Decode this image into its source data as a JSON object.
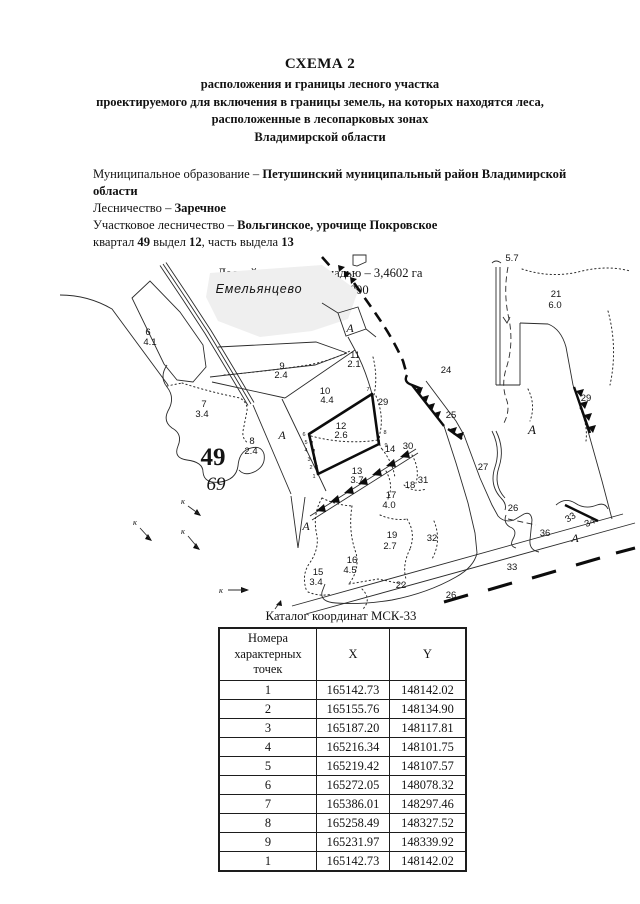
{
  "header": {
    "title": "СХЕМА 2",
    "subtitle": [
      "расположения и границы лесного участка",
      "проектируемого для включения в границы земель, на которых находятся леса,",
      "расположенные в лесопарковых зонах",
      "Владимирской области"
    ]
  },
  "info": {
    "municipal_label": "Муниципальное образование – ",
    "municipal_value": "Петушинский муниципальный район Владимирской области",
    "forestry_label": "Лесничество – ",
    "forestry_value": "Заречное",
    "district_label": "Участковое лесничество – ",
    "district_value": "Вольгинское, урочище Покровское",
    "quarter": {
      "p1": "квартал ",
      "n1": "49",
      "p2": " выдел ",
      "n2": "12",
      "p3": ", часть выдела ",
      "n3": "13"
    }
  },
  "map": {
    "area_line": "Лесной участок площадью – 3,4602 га",
    "scale_line": "Масштаб 1:10 000",
    "labels": [
      {
        "t": "Емельянцево",
        "x": 199,
        "y": 40,
        "c": "vil"
      },
      {
        "t": "5.7",
        "x": 452,
        "y": 8,
        "c": "n"
      },
      {
        "t": "21",
        "x": 496,
        "y": 44,
        "c": "n"
      },
      {
        "t": "6.0",
        "x": 495,
        "y": 55,
        "c": "n"
      },
      {
        "t": "6",
        "x": 88,
        "y": 82,
        "c": "n"
      },
      {
        "t": "4.1",
        "x": 90,
        "y": 92,
        "c": "n"
      },
      {
        "t": "7",
        "x": 144,
        "y": 154,
        "c": "n"
      },
      {
        "t": "3.4",
        "x": 142,
        "y": 164,
        "c": "n"
      },
      {
        "t": "9",
        "x": 222,
        "y": 116,
        "c": "n"
      },
      {
        "t": "2.4",
        "x": 221,
        "y": 125,
        "c": "n"
      },
      {
        "t": "10",
        "x": 265,
        "y": 141,
        "c": "n"
      },
      {
        "t": "4.4",
        "x": 267,
        "y": 150,
        "c": "n"
      },
      {
        "t": "11",
        "x": 295,
        "y": 105,
        "c": "n"
      },
      {
        "t": "2.1",
        "x": 294,
        "y": 114,
        "c": "n"
      },
      {
        "t": "29",
        "x": 323,
        "y": 152,
        "c": "n"
      },
      {
        "t": "24",
        "x": 386,
        "y": 120,
        "c": "n"
      },
      {
        "t": "25",
        "x": 391,
        "y": 165,
        "c": "n"
      },
      {
        "t": "29",
        "x": 526,
        "y": 148,
        "c": "n"
      },
      {
        "t": "12",
        "x": 281,
        "y": 176,
        "c": "n"
      },
      {
        "t": "2.6",
        "x": 281,
        "y": 185,
        "c": "n"
      },
      {
        "t": "8",
        "x": 192,
        "y": 191,
        "c": "n"
      },
      {
        "t": "2.4",
        "x": 191,
        "y": 201,
        "c": "n"
      },
      {
        "t": "13",
        "x": 297,
        "y": 221,
        "c": "n"
      },
      {
        "t": "3.7",
        "x": 297,
        "y": 230,
        "c": "n"
      },
      {
        "t": "14",
        "x": 330,
        "y": 199,
        "c": "n"
      },
      {
        "t": "30",
        "x": 348,
        "y": 196,
        "c": "n"
      },
      {
        "t": "18",
        "x": 350,
        "y": 235,
        "c": "n"
      },
      {
        "t": "31",
        "x": 363,
        "y": 230,
        "c": "n"
      },
      {
        "t": "17",
        "x": 331,
        "y": 245,
        "c": "n"
      },
      {
        "t": "4.0",
        "x": 329,
        "y": 255,
        "c": "n"
      },
      {
        "t": "19",
        "x": 332,
        "y": 285,
        "c": "n"
      },
      {
        "t": "2.7",
        "x": 330,
        "y": 296,
        "c": "n"
      },
      {
        "t": "32",
        "x": 372,
        "y": 288,
        "c": "n"
      },
      {
        "t": "16",
        "x": 292,
        "y": 310,
        "c": "n"
      },
      {
        "t": "4.5",
        "x": 290,
        "y": 320,
        "c": "n"
      },
      {
        "t": "15",
        "x": 258,
        "y": 322,
        "c": "n"
      },
      {
        "t": "3.4",
        "x": 256,
        "y": 332,
        "c": "n"
      },
      {
        "t": "22",
        "x": 341,
        "y": 335,
        "c": "n"
      },
      {
        "t": "26",
        "x": 391,
        "y": 345,
        "c": "n"
      },
      {
        "t": "33",
        "x": 452,
        "y": 317,
        "c": "n"
      },
      {
        "t": "27",
        "x": 423,
        "y": 217,
        "c": "n"
      },
      {
        "t": "26",
        "x": 453,
        "y": 258,
        "c": "n"
      },
      {
        "t": "36",
        "x": 485,
        "y": 283,
        "c": "n"
      },
      {
        "t": "33",
        "x": 512,
        "y": 267,
        "c": "n",
        "r": -32
      },
      {
        "t": "34",
        "x": 531,
        "y": 272,
        "c": "n",
        "r": -25
      },
      {
        "t": "49",
        "x": 153,
        "y": 212,
        "c": "b49"
      },
      {
        "t": "69",
        "x": 156,
        "y": 237,
        "c": "i69"
      },
      {
        "t": "А",
        "x": 222,
        "y": 186,
        "c": "A"
      },
      {
        "t": "А",
        "x": 290,
        "y": 79,
        "c": "A"
      },
      {
        "t": "А",
        "x": 472,
        "y": 181,
        "c": "Abig"
      },
      {
        "t": "А",
        "x": 246,
        "y": 277,
        "c": "A"
      },
      {
        "t": "А",
        "x": 515,
        "y": 289,
        "c": "A"
      },
      {
        "t": "к",
        "x": 123,
        "y": 251,
        "c": "k"
      },
      {
        "t": "к",
        "x": 75,
        "y": 272,
        "c": "k"
      },
      {
        "t": "к",
        "x": 123,
        "y": 281,
        "c": "k"
      },
      {
        "t": "к",
        "x": 161,
        "y": 340,
        "c": "k"
      },
      {
        "t": "7",
        "x": 308,
        "y": 138,
        "c": "pt"
      },
      {
        "t": "6",
        "x": 244,
        "y": 183,
        "c": "pt"
      },
      {
        "t": "5",
        "x": 246,
        "y": 191,
        "c": "pt"
      },
      {
        "t": "4",
        "x": 246,
        "y": 199,
        "c": "pt"
      },
      {
        "t": "3",
        "x": 249,
        "y": 208,
        "c": "pt"
      },
      {
        "t": "2",
        "x": 251,
        "y": 216,
        "c": "pt"
      },
      {
        "t": "1",
        "x": 254,
        "y": 225,
        "c": "pt"
      },
      {
        "t": "8",
        "x": 325,
        "y": 181,
        "c": "pt"
      },
      {
        "t": "9",
        "x": 326,
        "y": 194,
        "c": "pt"
      }
    ]
  },
  "table": {
    "title": "Каталог координат МСК-33",
    "col1": "Номера\nхарактерных\nточек",
    "col2": "X",
    "col3": "Y",
    "rows": [
      [
        "1",
        "165142.73",
        "148142.02"
      ],
      [
        "2",
        "165155.76",
        "148134.90"
      ],
      [
        "3",
        "165187.20",
        "148117.81"
      ],
      [
        "4",
        "165216.34",
        "148101.75"
      ],
      [
        "5",
        "165219.42",
        "148107.57"
      ],
      [
        "6",
        "165272.05",
        "148078.32"
      ],
      [
        "7",
        "165386.01",
        "148297.46"
      ],
      [
        "8",
        "165258.49",
        "148327.52"
      ],
      [
        "9",
        "165231.97",
        "148339.92"
      ],
      [
        "1",
        "165142.73",
        "148142.02"
      ]
    ]
  }
}
